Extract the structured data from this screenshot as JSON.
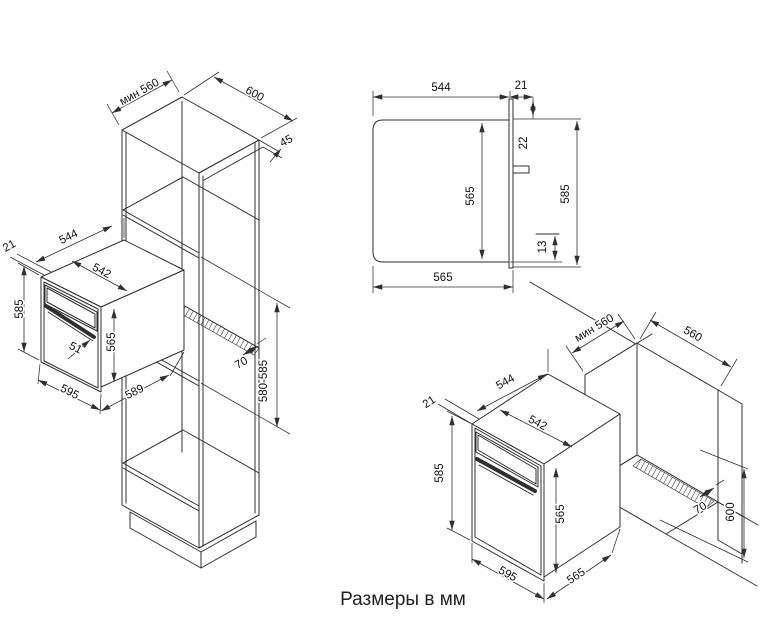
{
  "caption": "Размеры в мм",
  "diagram": {
    "column_view": {
      "min_depth": "мин 560",
      "cabinet_width": "600",
      "top_trim": "45",
      "vent_gap": "70",
      "niche_height": "580-585",
      "oven": {
        "door_lip": "21",
        "body_depth": "544",
        "body_width": "542",
        "door_height": "585",
        "body_height": "565",
        "handle_depth": "51",
        "door_width": "595",
        "overall_depth": "589"
      }
    },
    "side_view": {
      "body_depth": "544",
      "door_thickness": "21",
      "door_top_overhang": "22",
      "body_height": "565",
      "door_height": "585",
      "door_bottom_overhang": "13",
      "overall_depth": "565"
    },
    "base_view": {
      "min_depth": "мин 560",
      "niche_width": "560",
      "vent_gap": "70",
      "niche_height": "600",
      "oven": {
        "door_lip": "21",
        "body_depth": "544",
        "body_width": "542",
        "door_height": "585",
        "body_height": "565",
        "door_width": "595",
        "overall_depth": "565"
      }
    }
  }
}
